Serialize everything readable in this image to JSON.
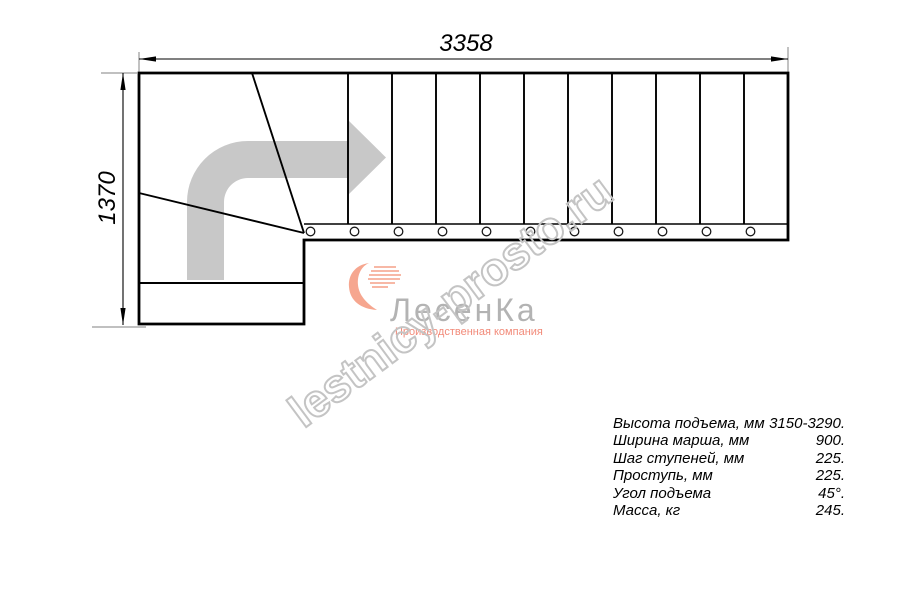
{
  "dimensions": {
    "total_length_mm": "3358",
    "total_width_mm": "1370"
  },
  "watermark": {
    "text": "lestnicy-prosto.ru"
  },
  "logo": {
    "name": "ЛесенКа",
    "subtitle": "Производственная компания"
  },
  "specs": {
    "rows": [
      {
        "label": "Высота подъема, мм",
        "value": "3150-3290."
      },
      {
        "label": "Ширина марша, мм",
        "value": "900."
      },
      {
        "label": "Шаг ступеней, мм",
        "value": "225."
      },
      {
        "label": "Проступь, мм",
        "value": "225."
      },
      {
        "label": "Угол подъема",
        "value": "45°."
      },
      {
        "label": "Масса, кг",
        "value": "245."
      }
    ]
  },
  "colors": {
    "drawing_line": "#000000",
    "extension_line": "#9a9a9a",
    "travel_arrow": "#c8c8c8",
    "watermark_outline": "#c4c4c4",
    "logo_text": "#b3b3b3",
    "logo_accent": "#f6a68f",
    "logo_subtitle": "#f28a79"
  }
}
